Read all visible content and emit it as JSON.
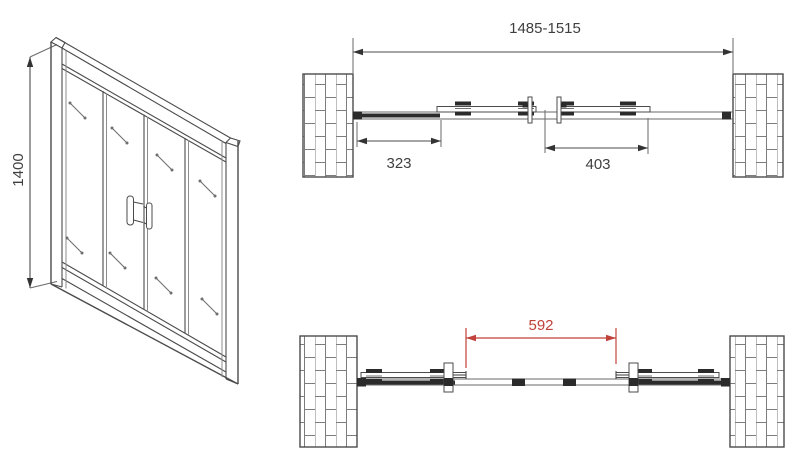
{
  "views": {
    "front": {
      "height": "1400"
    },
    "plan_closed": {
      "overall_width": "1485-1515",
      "left_fixed_panel": "323",
      "sliding_panel": "403"
    },
    "plan_open": {
      "clear_opening": "592"
    }
  },
  "colors": {
    "line": "#4b4b4b",
    "dimension_red": "#c0413a"
  }
}
